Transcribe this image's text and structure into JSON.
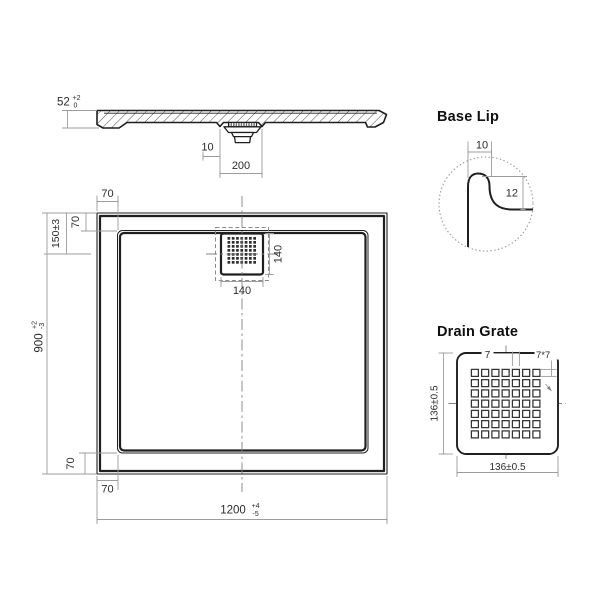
{
  "colors": {
    "object_line": "#1f1f1f",
    "dimension_line": "#9c9c9c",
    "text_color": "#2b2b2b"
  },
  "side_view": {
    "height_value": "52",
    "height_tol_upper": "+2",
    "height_tol_lower": "0",
    "drain_offset": "10",
    "drain_width": "200"
  },
  "plan_view": {
    "top_border": "70",
    "top_left_border": "70",
    "drain_center_from_top": "150±3",
    "depth_value": "900",
    "depth_tol_upper": "+2",
    "depth_tol_lower": "-3",
    "bottom_left_border_vertical": "70",
    "bottom_left_border_horizontal": "70",
    "width_value": "1200",
    "width_tol_upper": "+4",
    "width_tol_lower": "-5",
    "grate_width": "140",
    "grate_height": "140"
  },
  "base_lip_detail": {
    "title": "Base Lip",
    "lip_width": "10",
    "lip_height": "12"
  },
  "drain_grate_detail": {
    "title": "Drain Grate",
    "hole_spacing": "7",
    "hole_size": "7*7",
    "side_left": "136±0.5",
    "side_bottom": "136±0.5"
  }
}
